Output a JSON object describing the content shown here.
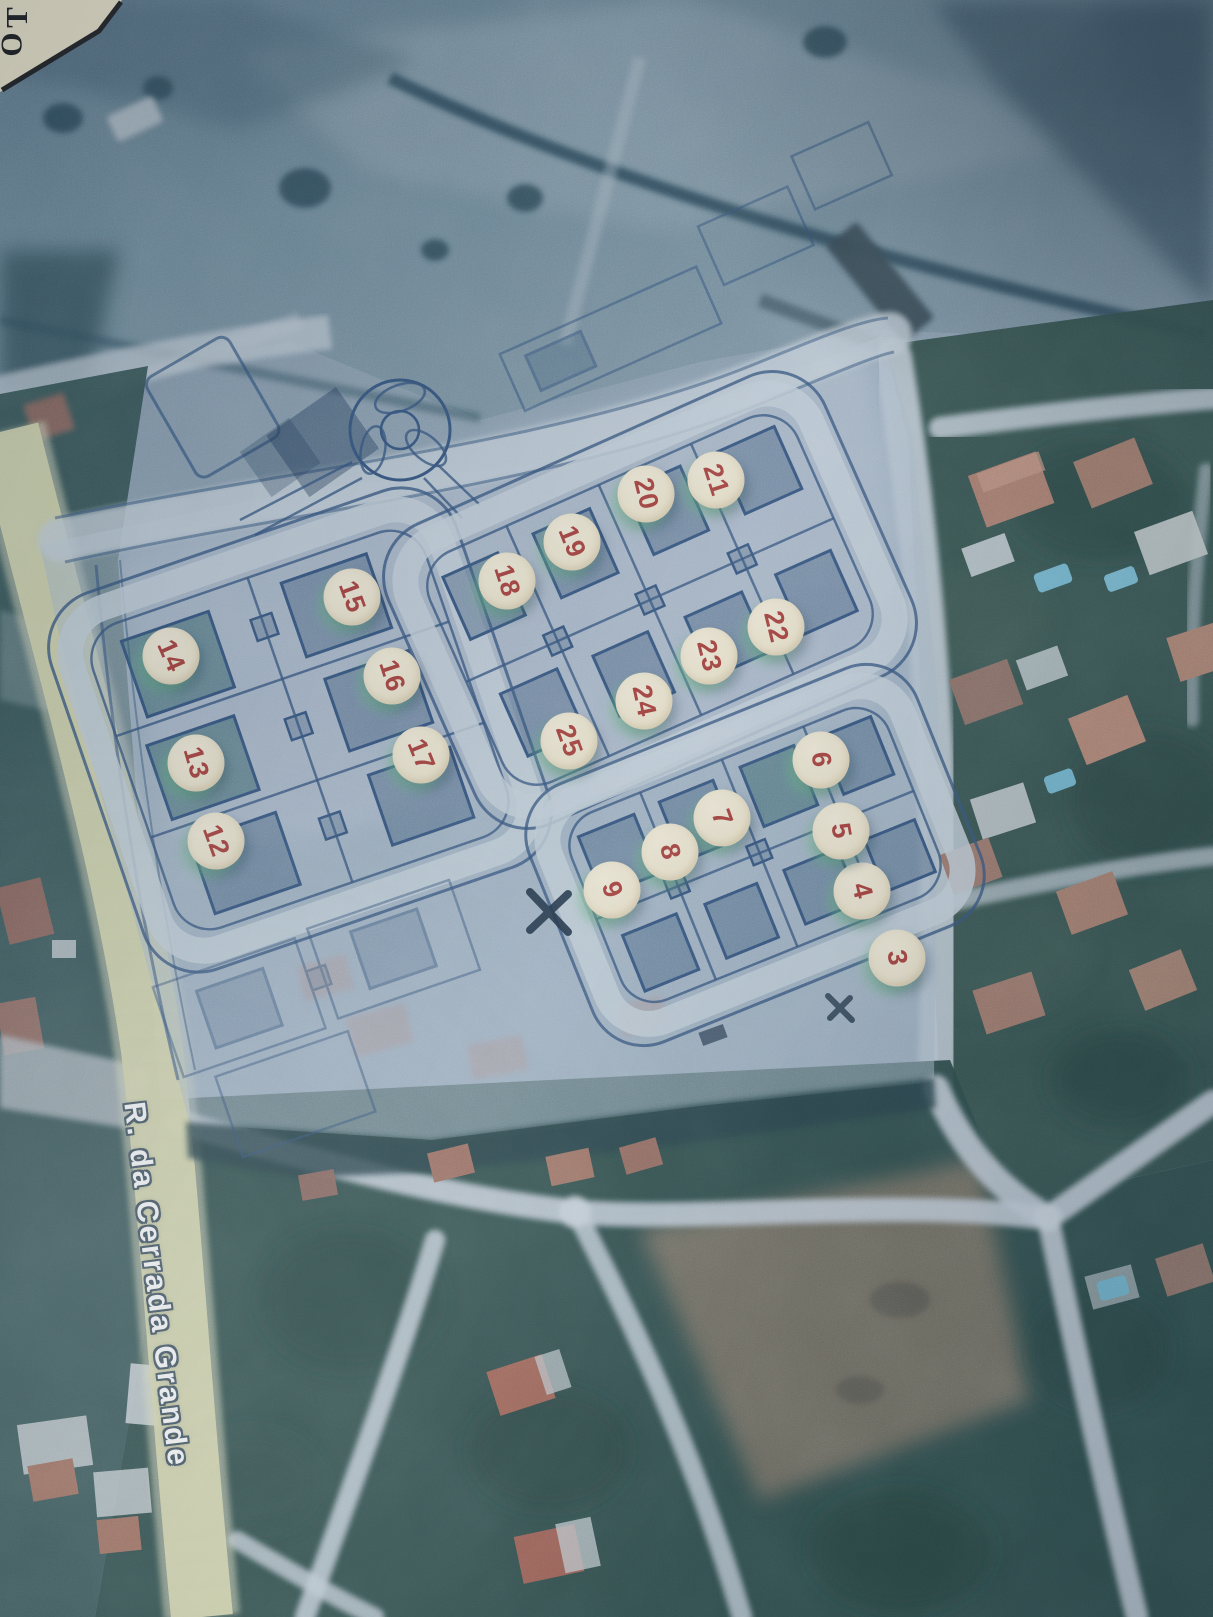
{
  "map": {
    "street_label": "R. da Cerrada Grande",
    "corner_label_fragment": "TO",
    "lot_markers": [
      {
        "number": "3",
        "x": 897,
        "y": 958,
        "rotation_deg": 80
      },
      {
        "number": "4",
        "x": 862,
        "y": 891,
        "rotation_deg": 76
      },
      {
        "number": "5",
        "x": 841,
        "y": 831,
        "rotation_deg": 80
      },
      {
        "number": "6",
        "x": 821,
        "y": 760,
        "rotation_deg": 84
      },
      {
        "number": "7",
        "x": 722,
        "y": 818,
        "rotation_deg": 70
      },
      {
        "number": "8",
        "x": 670,
        "y": 852,
        "rotation_deg": 76
      },
      {
        "number": "9",
        "x": 612,
        "y": 890,
        "rotation_deg": 72
      },
      {
        "number": "12",
        "x": 216,
        "y": 841,
        "rotation_deg": 70
      },
      {
        "number": "13",
        "x": 196,
        "y": 763,
        "rotation_deg": 74
      },
      {
        "number": "14",
        "x": 171,
        "y": 656,
        "rotation_deg": 66
      },
      {
        "number": "15",
        "x": 352,
        "y": 597,
        "rotation_deg": 70
      },
      {
        "number": "16",
        "x": 392,
        "y": 676,
        "rotation_deg": 72
      },
      {
        "number": "17",
        "x": 421,
        "y": 755,
        "rotation_deg": 68
      },
      {
        "number": "18",
        "x": 507,
        "y": 581,
        "rotation_deg": 72
      },
      {
        "number": "19",
        "x": 572,
        "y": 542,
        "rotation_deg": 68
      },
      {
        "number": "20",
        "x": 646,
        "y": 494,
        "rotation_deg": 76
      },
      {
        "number": "21",
        "x": 716,
        "y": 480,
        "rotation_deg": 72
      },
      {
        "number": "22",
        "x": 776,
        "y": 627,
        "rotation_deg": 76
      },
      {
        "number": "23",
        "x": 709,
        "y": 656,
        "rotation_deg": 76
      },
      {
        "number": "24",
        "x": 644,
        "y": 701,
        "rotation_deg": 78
      },
      {
        "number": "25",
        "x": 569,
        "y": 741,
        "rotation_deg": 70
      }
    ],
    "colors": {
      "marker_bg": "#f2e8cc",
      "marker_text": "#a63832",
      "marker_halo": "#62be7a",
      "plan_line": "#2e4e78",
      "plan_wash": "#adbdce",
      "road_light": "#c6d2da",
      "street_band": "#d7d8ab",
      "veg_dark": "#2b4942",
      "paper": "#ede3c4"
    }
  }
}
